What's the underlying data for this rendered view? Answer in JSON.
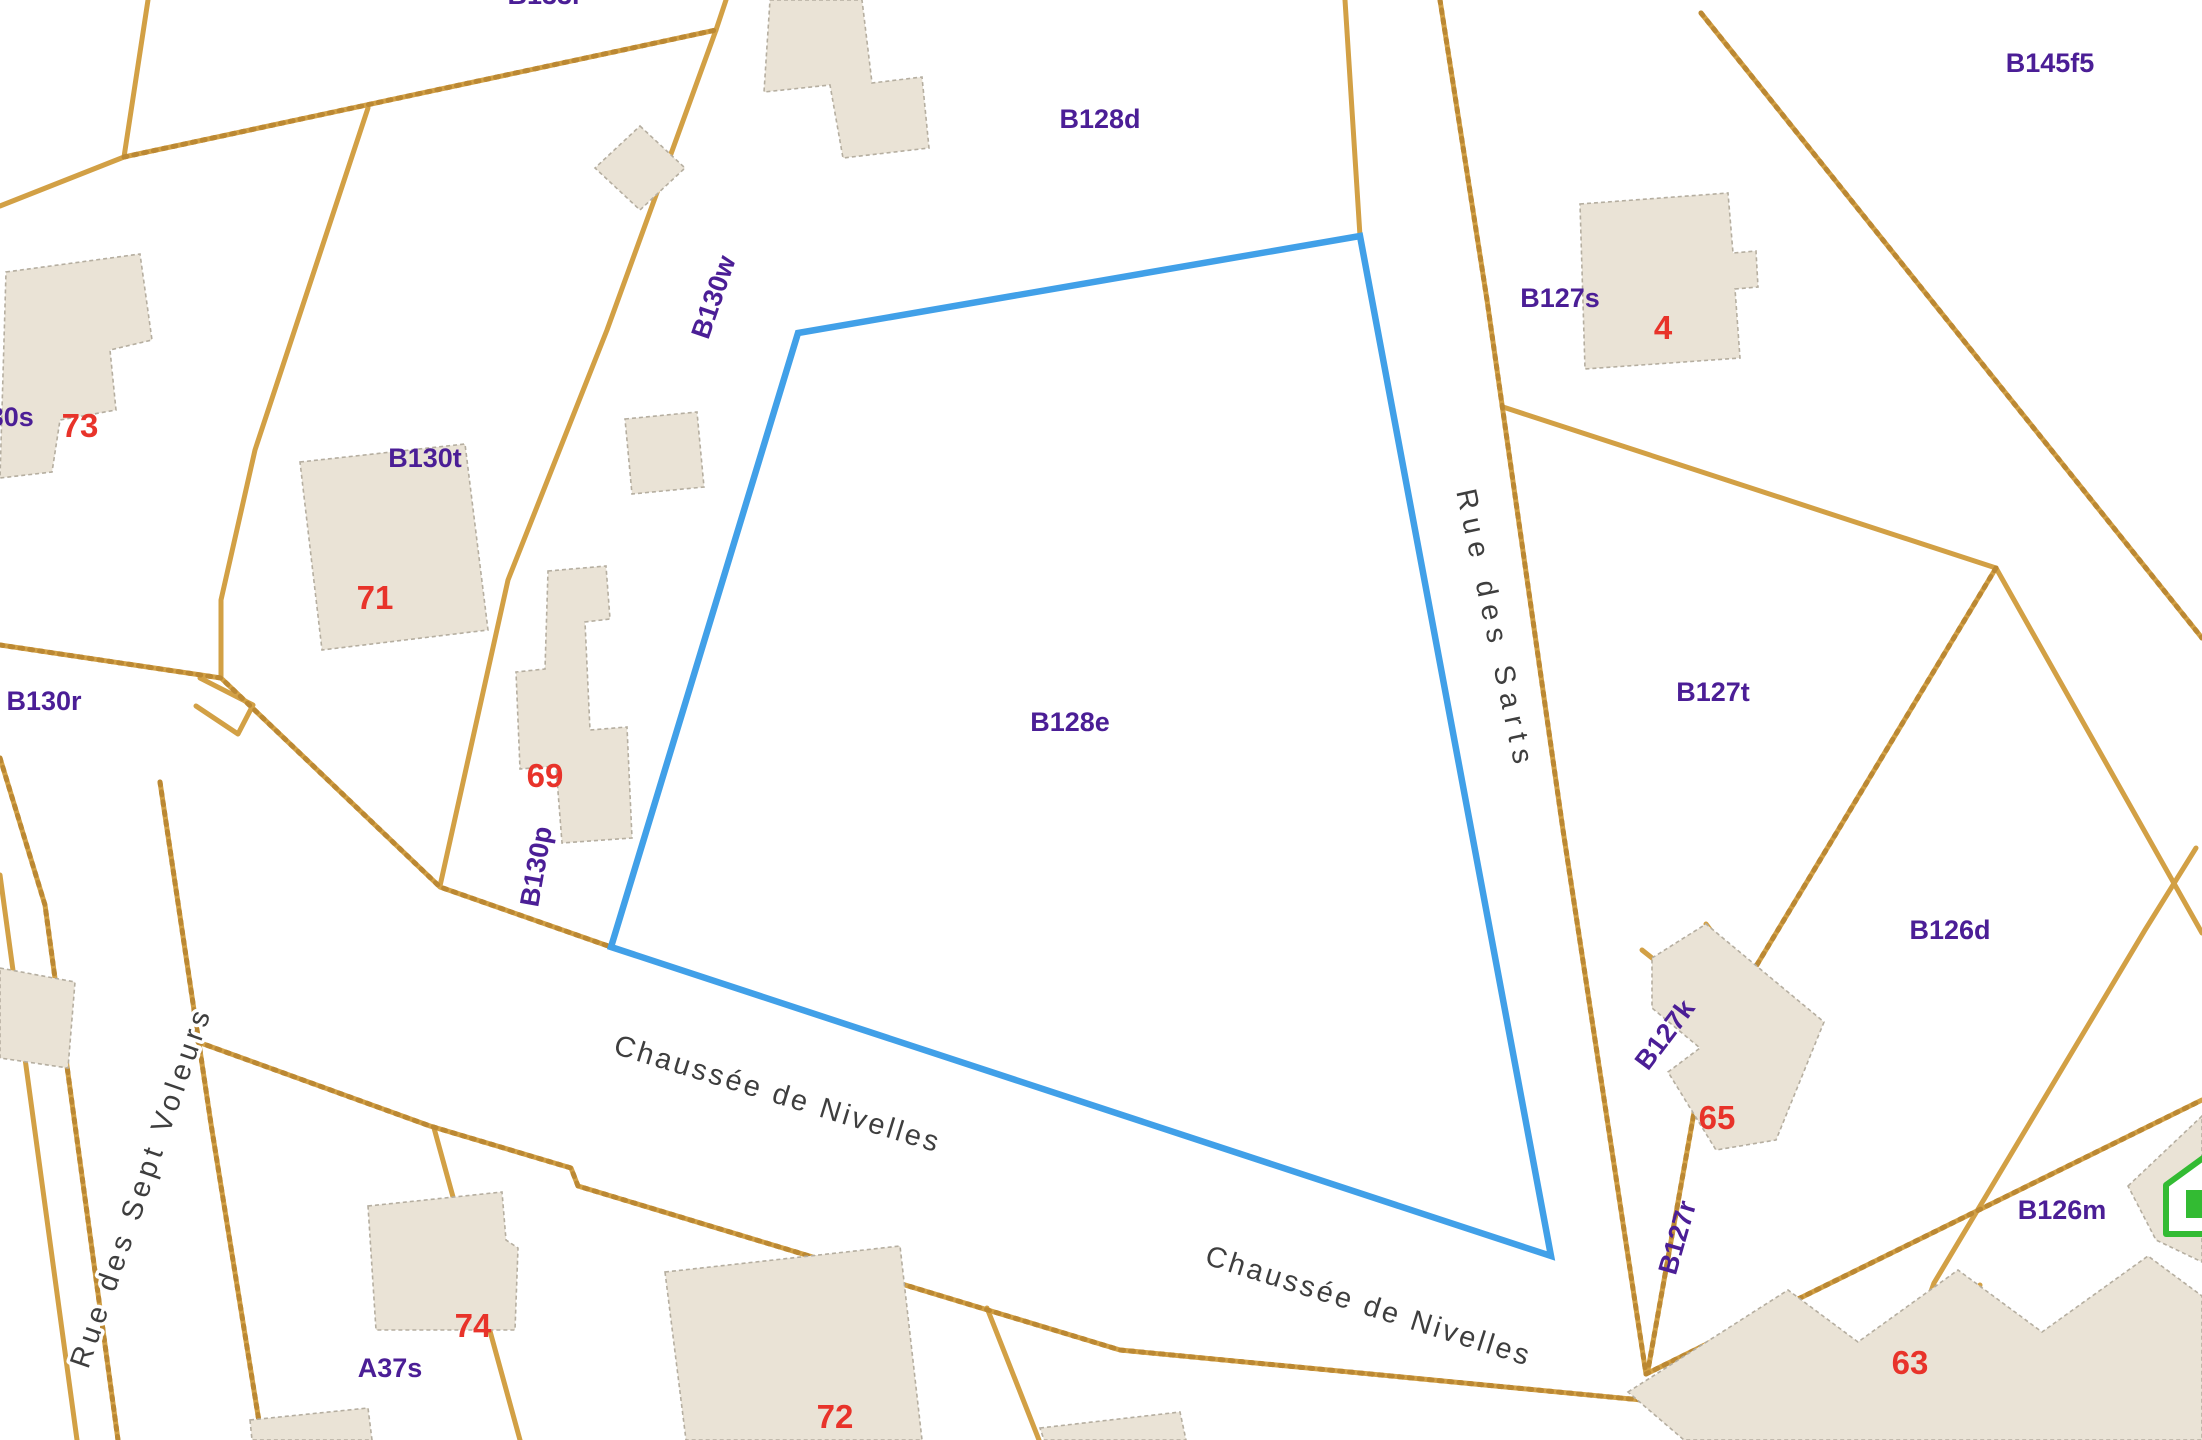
{
  "selected_parcel": "B128e",
  "colors": {
    "parcel_line": "#d2a045",
    "parcel_line_dark": "#bb8833",
    "building_fill": "#eae3d6",
    "building_stroke": "#b5aea0",
    "highlight_outline": "#41a0e8",
    "parcel_label": "#4b1e96",
    "house_number": "#e8332a",
    "street_label": "#3e3e3e",
    "marker_green": "#33bb33"
  },
  "highlight": {
    "parcel_id": "B128e",
    "points": "798,333 1360,236 1551,1256 611,947"
  },
  "parcel_labels": [
    {
      "id": "B133r",
      "text": "B133r"
    },
    {
      "id": "B128d",
      "text": "B128d"
    },
    {
      "id": "B145f5",
      "text": "B145f5"
    },
    {
      "id": "B130w",
      "text": "B130w"
    },
    {
      "id": "B130s",
      "text": "B130s"
    },
    {
      "id": "B130t",
      "text": "B130t"
    },
    {
      "id": "B130r",
      "text": "B130r"
    },
    {
      "id": "B130p",
      "text": "B130p"
    },
    {
      "id": "B128e",
      "text": "B128e"
    },
    {
      "id": "B127s",
      "text": "B127s"
    },
    {
      "id": "B127t",
      "text": "B127t"
    },
    {
      "id": "B126d",
      "text": "B126d"
    },
    {
      "id": "B127k",
      "text": "B127k"
    },
    {
      "id": "B127r",
      "text": "B127r"
    },
    {
      "id": "B126m",
      "text": "B126m"
    },
    {
      "id": "A37s",
      "text": "A37s"
    }
  ],
  "house_numbers": [
    {
      "id": "73",
      "text": "73"
    },
    {
      "id": "71",
      "text": "71"
    },
    {
      "id": "69",
      "text": "69"
    },
    {
      "id": "4",
      "text": "4"
    },
    {
      "id": "65",
      "text": "65"
    },
    {
      "id": "63",
      "text": "63"
    },
    {
      "id": "74",
      "text": "74"
    },
    {
      "id": "72",
      "text": "72"
    }
  ],
  "street_labels": [
    {
      "id": "chaussee-de-nivelles-west",
      "text": "Chaussée de Nivelles"
    },
    {
      "id": "chaussee-de-nivelles-east",
      "text": "Chaussée de Nivelles"
    },
    {
      "id": "rue-des-sarts",
      "text": "Rue des Sarts"
    },
    {
      "id": "rue-des-sept-voleurs",
      "text": "Rue des Sept Voleurs"
    }
  ]
}
